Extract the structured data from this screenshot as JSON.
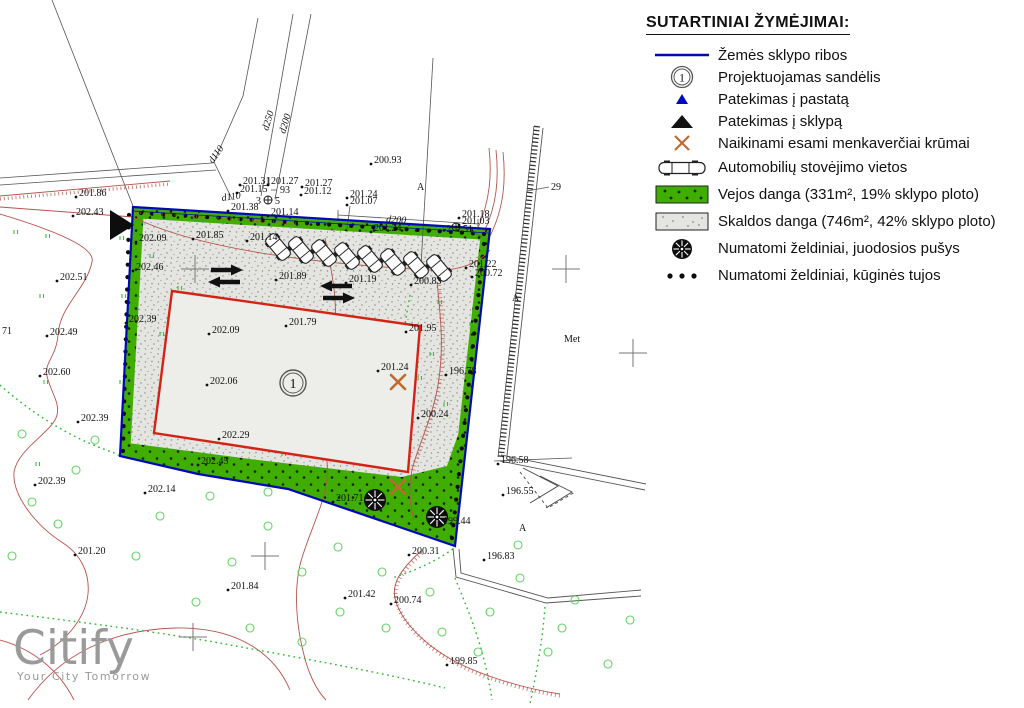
{
  "legend": {
    "title": "SUTARTINIAI ŽYMĖJIMAI:",
    "items": [
      {
        "icon": "boundary-line",
        "label": "Žemės sklypo ribos"
      },
      {
        "icon": "numbered-circle",
        "label": "Projektuojamas sandėlis",
        "symbol": "1"
      },
      {
        "icon": "blue-triangle",
        "label": "Patekimas į pastatą"
      },
      {
        "icon": "black-triangle",
        "label": "Patekimas į sklypą"
      },
      {
        "icon": "x-mark",
        "label": "Naikinami esami menkaverčiai krūmai"
      },
      {
        "icon": "car",
        "label": "Automobilių stovėjimo vietos"
      },
      {
        "icon": "lawn-swatch",
        "label": "Vejos danga (331m², 19% sklypo ploto)"
      },
      {
        "icon": "gravel-swatch",
        "label": "Skaldos danga (746m², 42% sklypo ploto)"
      },
      {
        "icon": "pine",
        "label": "Numatomi želdiniai, juodosios pušys"
      },
      {
        "icon": "thuja-dots",
        "label": "Numatomi želdiniai, kūginės tujos"
      }
    ]
  },
  "logo": {
    "name": "Citify",
    "tagline": "Your City Tomorrow"
  },
  "plan": {
    "building_number": "1",
    "points": [
      {
        "t": "200.93",
        "x": 374,
        "y": 163
      },
      {
        "t": "201.31",
        "x": 243,
        "y": 184
      },
      {
        "t": "201.27",
        "x": 271,
        "y": 184
      },
      {
        "t": "201.15",
        "x": 240,
        "y": 192
      },
      {
        "t": "93",
        "x": 280,
        "y": 193,
        "nd": true
      },
      {
        "t": "201.27",
        "x": 305,
        "y": 186
      },
      {
        "t": "201.12",
        "x": 304,
        "y": 194
      },
      {
        "t": "201.38",
        "x": 231,
        "y": 210
      },
      {
        "t": "201.14",
        "x": 271,
        "y": 215
      },
      {
        "t": "201.24",
        "x": 350,
        "y": 197
      },
      {
        "t": "201.07",
        "x": 350,
        "y": 204
      },
      {
        "t": "201.24",
        "x": 374,
        "y": 231
      },
      {
        "t": "201.18",
        "x": 462,
        "y": 217
      },
      {
        "t": "201.03",
        "x": 462,
        "y": 224
      },
      {
        "t": "-2",
        "x": 443,
        "y": 232,
        "nd": true
      },
      {
        "t": "51",
        "x": 463,
        "y": 232,
        "nd": true
      },
      {
        "t": "201.86",
        "x": 79,
        "y": 196
      },
      {
        "t": "202.43",
        "x": 76,
        "y": 215
      },
      {
        "t": "202.09",
        "x": 139,
        "y": 241
      },
      {
        "t": "201.85",
        "x": 196,
        "y": 238
      },
      {
        "t": "201.14",
        "x": 250,
        "y": 240
      },
      {
        "t": "202.46",
        "x": 136,
        "y": 270
      },
      {
        "t": "202.51",
        "x": 60,
        "y": 280
      },
      {
        "t": "201.89",
        "x": 279,
        "y": 279
      },
      {
        "t": "201.19",
        "x": 349,
        "y": 282
      },
      {
        "t": "200.83",
        "x": 414,
        "y": 284
      },
      {
        "t": "201.22",
        "x": 469,
        "y": 267
      },
      {
        "t": "200.72",
        "x": 475,
        "y": 276
      },
      {
        "t": "202.39",
        "x": 129,
        "y": 322
      },
      {
        "t": "202.49",
        "x": 50,
        "y": 335
      },
      {
        "t": "202.09",
        "x": 212,
        "y": 333
      },
      {
        "t": "201.79",
        "x": 289,
        "y": 325
      },
      {
        "t": "201.95",
        "x": 409,
        "y": 331
      },
      {
        "t": "202.60",
        "x": 43,
        "y": 375
      },
      {
        "t": "202.06",
        "x": 210,
        "y": 384
      },
      {
        "t": "201.24",
        "x": 381,
        "y": 370
      },
      {
        "t": "196.78",
        "x": 449,
        "y": 374
      },
      {
        "t": "200.24",
        "x": 421,
        "y": 417
      },
      {
        "t": "202.39",
        "x": 81,
        "y": 421
      },
      {
        "t": "202.29",
        "x": 222,
        "y": 438
      },
      {
        "t": "202.45",
        "x": 201,
        "y": 464
      },
      {
        "t": "202.14",
        "x": 148,
        "y": 492
      },
      {
        "t": "202.39",
        "x": 38,
        "y": 484
      },
      {
        "t": "201.71",
        "x": 336,
        "y": 501
      },
      {
        "t": "199.44",
        "x": 443,
        "y": 524
      },
      {
        "t": "201.20",
        "x": 78,
        "y": 554
      },
      {
        "t": "200.31",
        "x": 412,
        "y": 554
      },
      {
        "t": "196.83",
        "x": 487,
        "y": 559
      },
      {
        "t": "196.58",
        "x": 501,
        "y": 463
      },
      {
        "t": "196.55",
        "x": 506,
        "y": 494
      },
      {
        "t": "201.84",
        "x": 231,
        "y": 589
      },
      {
        "t": "201.42",
        "x": 348,
        "y": 597
      },
      {
        "t": "200.74",
        "x": 394,
        "y": 603
      },
      {
        "t": "199.85",
        "x": 450,
        "y": 664
      },
      {
        "t": "71",
        "x": 2,
        "y": 334,
        "nd": true
      }
    ],
    "texts": [
      {
        "t": "d110",
        "x": 213,
        "y": 164,
        "r": -55,
        "s": 12,
        "it": true
      },
      {
        "t": "d110",
        "x": 222,
        "y": 201,
        "r": -8,
        "s": 10,
        "it": true
      },
      {
        "t": "d250",
        "x": 268,
        "y": 131,
        "r": -73,
        "s": 11,
        "it": true
      },
      {
        "t": "d200",
        "x": 285,
        "y": 134,
        "r": -73,
        "s": 11,
        "it": true
      },
      {
        "t": "d200",
        "x": 386,
        "y": 222,
        "r": 4,
        "s": 11,
        "it": true
      },
      {
        "t": "A",
        "x": 417,
        "y": 190,
        "s": 11
      },
      {
        "t": "A",
        "x": 512,
        "y": 301,
        "s": 11
      },
      {
        "t": "A",
        "x": 519,
        "y": 531,
        "s": 11
      },
      {
        "t": "Met",
        "x": 564,
        "y": 342,
        "s": 11
      },
      {
        "t": "29",
        "x": 551,
        "y": 190,
        "s": 11
      },
      {
        "t": "3",
        "x": 256,
        "y": 204,
        "s": 6
      },
      {
        "t": "5",
        "x": 275,
        "y": 204,
        "s": 6
      }
    ]
  },
  "colors": {
    "boundary": "#0008b4",
    "building": "#d32315",
    "lawn": "#3fae00",
    "gravel": "#e4e4e0",
    "contour": "#b5544c",
    "xmark": "#bf6a30",
    "logo": "#9a9a9a"
  }
}
